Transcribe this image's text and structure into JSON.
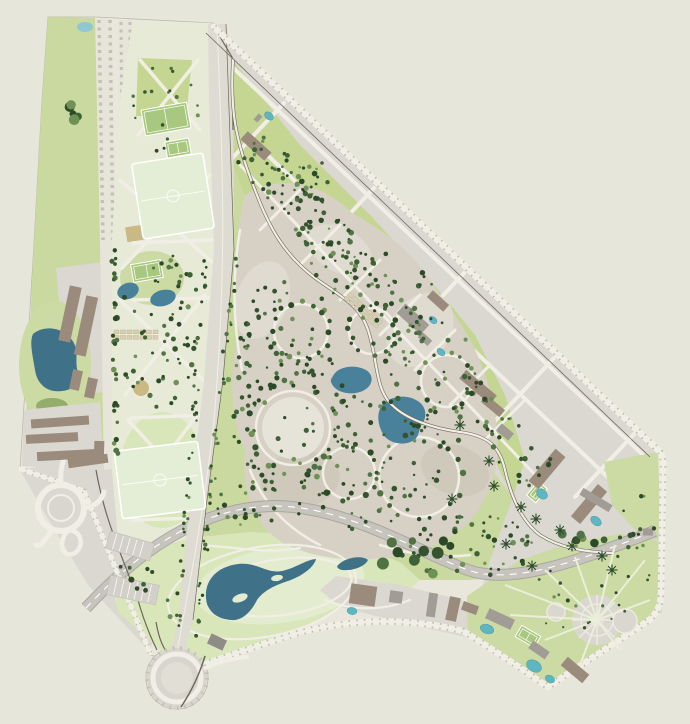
{
  "title": "park-master-plan-site-map",
  "canvas": {
    "width": 690,
    "height": 724
  },
  "colors": {
    "bg": "#e7e6da",
    "site": "#e9e7dc",
    "edge": "#bcb9ac",
    "green": "#c9d9a0",
    "greenMid": "#ccdaa4",
    "greenPale": "#e7ead6",
    "greenWedge": "#c5d693",
    "greenBright": "#d8e6ba",
    "lawn": "#e3ecce",
    "beige": "#d7d1c5",
    "lobeL": "#e0dbd0",
    "lobeD": "#cfc9bc",
    "gray": "#dad8d0",
    "road": "#e7e5da",
    "white": "#f1efe5",
    "tick": "#c3c1b5",
    "dark": "#6e665b",
    "hw": "#c6c4bc",
    "hwEdge": "#a9a79f",
    "avenue": "#dedcd2",
    "water": "#3f7189",
    "pond": "#49809a",
    "pool": "#5fb6c3",
    "pondTop": "#8fc7d2",
    "olive": "#93ad6c",
    "tan": "#c9ba85",
    "brown": "#9b8b7d",
    "bgray": "#a19d96",
    "bdark": "#8f8b85",
    "court": "#a9c87f",
    "field": "#e4eed6"
  },
  "map": {
    "features": [
      "park",
      "lakes",
      "ponds",
      "tree-clusters",
      "sports-fields",
      "residential-blocks",
      "highway",
      "avenue",
      "roundabouts",
      "radial-plaza"
    ],
    "trees": {
      "palette": [
        "#2c4a27",
        "#35532e",
        "#3f6136",
        "#507244",
        "#6f9156"
      ],
      "clusters": [
        {
          "type": "ellipse",
          "c": [
            160,
            332
          ],
          "rx": 42,
          "ry": 82,
          "n": 60
        },
        {
          "type": "ellipse",
          "c": [
            350,
            385
          ],
          "rx": 122,
          "ry": 145,
          "n": 200
        },
        {
          "type": "ellipse",
          "c": [
            468,
            545
          ],
          "rx": 70,
          "ry": 32,
          "n": 50
        },
        {
          "type": "ellipse",
          "c": [
            252,
            505
          ],
          "rx": 36,
          "ry": 26,
          "n": 24
        },
        {
          "type": "ellipse",
          "c": [
            166,
            110
          ],
          "rx": 36,
          "ry": 48,
          "n": 18,
          "rmin": 1,
          "rmax": 2
        },
        {
          "type": "ellipse",
          "c": [
            580,
            598
          ],
          "rx": 52,
          "ry": 34,
          "n": 18,
          "rmin": 1,
          "rmax": 2
        },
        {
          "type": "ellipse",
          "c": [
            636,
            540
          ],
          "rx": 20,
          "ry": 55,
          "n": 16
        },
        {
          "type": "ellipse",
          "c": [
            300,
            180
          ],
          "rx": 40,
          "ry": 30,
          "n": 25
        },
        {
          "type": "ellipse",
          "c": [
            430,
            556
          ],
          "rx": 58,
          "ry": 20,
          "n": 11,
          "rmin": 3.5,
          "rmax": 6
        },
        {
          "type": "ellipse",
          "c": [
            74,
            114
          ],
          "rx": 9,
          "ry": 13,
          "n": 5,
          "rmin": 3.5,
          "rmax": 6
        },
        {
          "type": "strip",
          "p1": [
            248,
            148
          ],
          "p2": [
            540,
            476
          ],
          "w": 44,
          "n": 150
        },
        {
          "type": "strip",
          "p1": [
            206,
            248
          ],
          "p2": [
            178,
            638
          ],
          "w": 6,
          "n": 42,
          "rmin": 1.2,
          "rmax": 2.2
        },
        {
          "type": "strip",
          "p1": [
            236,
            248
          ],
          "p2": [
            196,
            638
          ],
          "w": 6,
          "n": 42,
          "rmin": 1.2,
          "rmax": 2.2
        },
        {
          "type": "strip",
          "p1": [
            114,
            248
          ],
          "p2": [
            116,
            460
          ],
          "w": 5,
          "n": 30,
          "rmin": 1.6,
          "rmax": 3
        },
        {
          "type": "strip",
          "p1": [
            558,
            530
          ],
          "p2": [
            610,
            545
          ],
          "w": 10,
          "n": 7,
          "rmin": 3,
          "rmax": 4.5
        },
        {
          "type": "strip",
          "p1": [
            120,
            545
          ],
          "p2": [
            180,
            620
          ],
          "w": 30,
          "n": 12,
          "rmin": 1.5,
          "rmax": 3
        },
        {
          "type": "ring",
          "c": [
            293,
            428
          ],
          "r": 44,
          "n": 26,
          "rmin": 1.8,
          "rmax": 3.2
        },
        {
          "type": "ring",
          "c": [
            293,
            428
          ],
          "r": 57,
          "n": 17,
          "rmin": 1.6,
          "rmax": 3
        },
        {
          "type": "ring",
          "c": [
            301,
            331
          ],
          "r": 29,
          "n": 16,
          "rmin": 1.8,
          "rmax": 3.2
        },
        {
          "type": "ring",
          "c": [
            259,
            366
          ],
          "r": 22,
          "n": 12,
          "rmin": 1.6,
          "rmax": 2.8
        },
        {
          "type": "ring",
          "c": [
            349,
            473
          ],
          "r": 29,
          "n": 15,
          "rmin": 1.8,
          "rmax": 3.2
        },
        {
          "type": "ring",
          "c": [
            419,
            477
          ],
          "r": 43,
          "n": 19,
          "rmin": 1.8,
          "rmax": 3.2
        },
        {
          "type": "ring",
          "c": [
            372,
            331
          ],
          "r": 25,
          "n": 12,
          "rmin": 1.6,
          "rmax": 2.8
        },
        {
          "type": "ring",
          "c": [
            447,
            381
          ],
          "r": 28,
          "n": 13,
          "rmin": 1.6,
          "rmax": 2.8
        },
        {
          "type": "ring",
          "c": [
            331,
            262
          ],
          "r": 20,
          "n": 10,
          "rmin": 1.6,
          "rmax": 2.6
        },
        {
          "type": "ring",
          "c": [
            266,
            300
          ],
          "r": 13,
          "n": 8,
          "rmin": 1.4,
          "rmax": 2.4
        }
      ]
    },
    "star_trees": [
      [
        460,
        425
      ],
      [
        489,
        461
      ],
      [
        521,
        507
      ],
      [
        536,
        519
      ],
      [
        506,
        544
      ],
      [
        532,
        566
      ],
      [
        572,
        546
      ],
      [
        602,
        556
      ],
      [
        494,
        486
      ],
      [
        452,
        499
      ],
      [
        560,
        530
      ],
      [
        612,
        570
      ]
    ],
    "buildings": [
      [
        70,
        314,
        12,
        56,
        12,
        "brown"
      ],
      [
        86,
        326,
        12,
        60,
        12,
        "brown"
      ],
      [
        76,
        380,
        10,
        20,
        12,
        "brown"
      ],
      [
        91,
        388,
        10,
        20,
        12,
        "brown"
      ],
      [
        60,
        422,
        58,
        9,
        -4,
        "brown"
      ],
      [
        52,
        438,
        52,
        9,
        -3,
        "brown"
      ],
      [
        68,
        455,
        62,
        9,
        -3,
        "brown"
      ],
      [
        99,
        452,
        10,
        22,
        2,
        "brown"
      ],
      [
        88,
        461,
        40,
        9,
        -8,
        "brown"
      ],
      [
        256,
        146,
        32,
        11,
        42,
        "brown"
      ],
      [
        258,
        118,
        5,
        8,
        42,
        "bgray"
      ],
      [
        413,
        319,
        32,
        13,
        42,
        "bgray"
      ],
      [
        438,
        301,
        22,
        9,
        42,
        "brown"
      ],
      [
        425,
        339,
        13,
        7,
        42,
        "bgray"
      ],
      [
        478,
        387,
        40,
        11,
        40,
        "brown"
      ],
      [
        493,
        406,
        24,
        9,
        40,
        "brown"
      ],
      [
        505,
        432,
        16,
        9,
        40,
        "bgray"
      ],
      [
        547,
        469,
        13,
        42,
        40,
        "brown"
      ],
      [
        589,
        504,
        12,
        42,
        40,
        "brown"
      ],
      [
        596,
        500,
        8,
        34,
        -59,
        "bgray"
      ],
      [
        648,
        532,
        10,
        7,
        0,
        "bgray"
      ],
      [
        363,
        595,
        26,
        20,
        8,
        "brown"
      ],
      [
        396,
        597,
        13,
        12,
        8,
        "bgray"
      ],
      [
        432,
        605,
        9,
        24,
        8,
        "bgray"
      ],
      [
        453,
        609,
        11,
        24,
        12,
        "brown"
      ],
      [
        470,
        608,
        16,
        9,
        20,
        "brown"
      ],
      [
        500,
        619,
        28,
        11,
        25,
        "bgray"
      ],
      [
        539,
        650,
        20,
        9,
        35,
        "bgray"
      ],
      [
        575,
        670,
        28,
        11,
        40,
        "brown"
      ],
      [
        217,
        642,
        17,
        11,
        25,
        "bdark"
      ]
    ],
    "pools": [
      [
        269,
        116,
        5,
        3.5,
        40
      ],
      [
        433,
        320,
        4.5,
        3,
        40
      ],
      [
        441,
        352,
        4.5,
        3,
        40
      ],
      [
        542,
        494,
        6,
        4.5,
        40
      ],
      [
        596,
        521,
        6,
        4,
        40
      ],
      [
        352,
        611,
        5,
        3.5,
        10
      ],
      [
        487,
        629,
        7,
        4.5,
        20
      ],
      [
        534,
        666,
        8,
        5.5,
        30
      ],
      [
        550,
        679,
        5,
        3.5,
        30
      ]
    ],
    "courts": [
      [
        143,
        106,
        46,
        26,
        -10
      ],
      [
        166,
        140,
        24,
        16,
        -10
      ],
      [
        132,
        262,
        30,
        18,
        -10
      ],
      [
        531,
        483,
        12,
        18,
        40
      ],
      [
        517,
        630,
        22,
        13,
        30
      ]
    ],
    "fields": [
      [
        137,
        158,
        72,
        76,
        -9
      ],
      [
        118,
        446,
        84,
        68,
        -7
      ]
    ],
    "gardens": [
      [
        114,
        330,
        0
      ],
      [
        350,
        292,
        42
      ]
    ],
    "parking": [
      [
        130,
        546,
        46,
        18,
        16
      ],
      [
        133,
        590,
        50,
        20,
        12
      ]
    ]
  }
}
